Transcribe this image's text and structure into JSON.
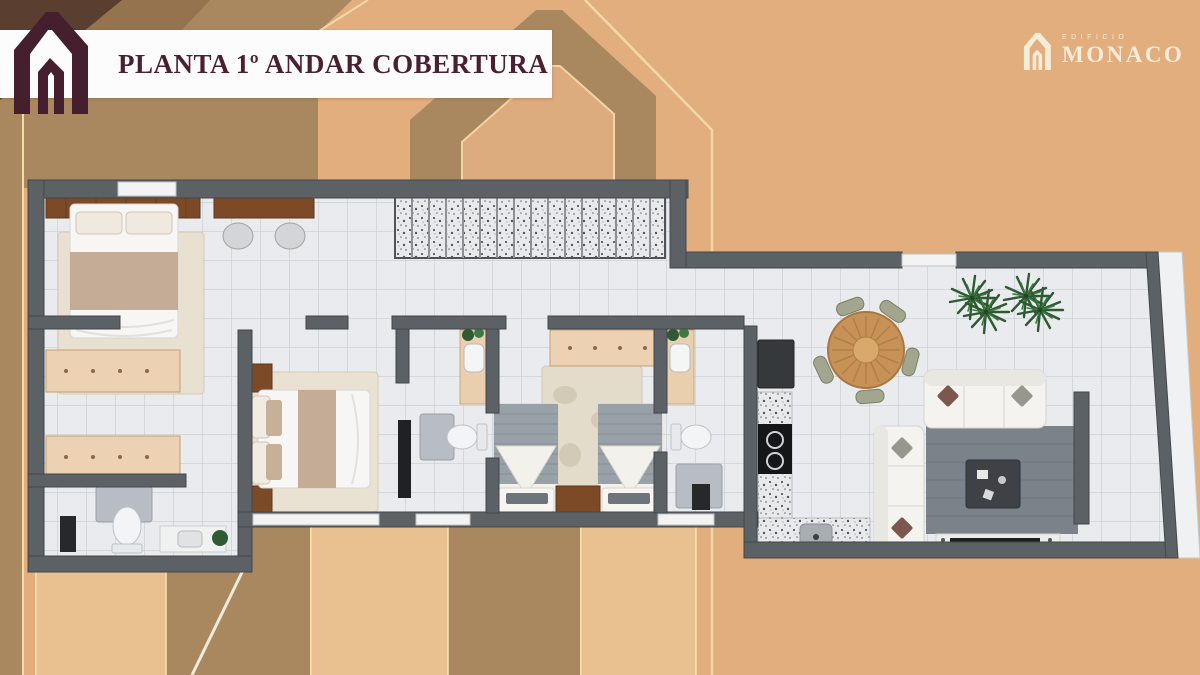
{
  "banner": {
    "title": "PLANTA 1º ANDAR COBERTURA"
  },
  "brand": {
    "tagline": "EDIFICIO",
    "name": "MONACO"
  },
  "palette": {
    "background_tan": "#e2ae7d",
    "shape_brown": "#a9885f",
    "accent_gold": "#f0d9a6",
    "banner_bg": "#fcfcfc",
    "title_maroon": "#4a1f31",
    "logo_maroon": "#451f2e",
    "brand_cream": "#f6ecd9",
    "wall_gray": "#5c6165",
    "floor_tile": "#e9ebee",
    "stair_granite": "#e8e9ea",
    "wood_dark": "#7c4a26",
    "wood_light": "#ecd2b2",
    "fabric_tan": "#c4ac96",
    "rug_beige": "#e8e0d1",
    "rug_gray": "#7b828a",
    "plant_green": "#2e5b33"
  }
}
